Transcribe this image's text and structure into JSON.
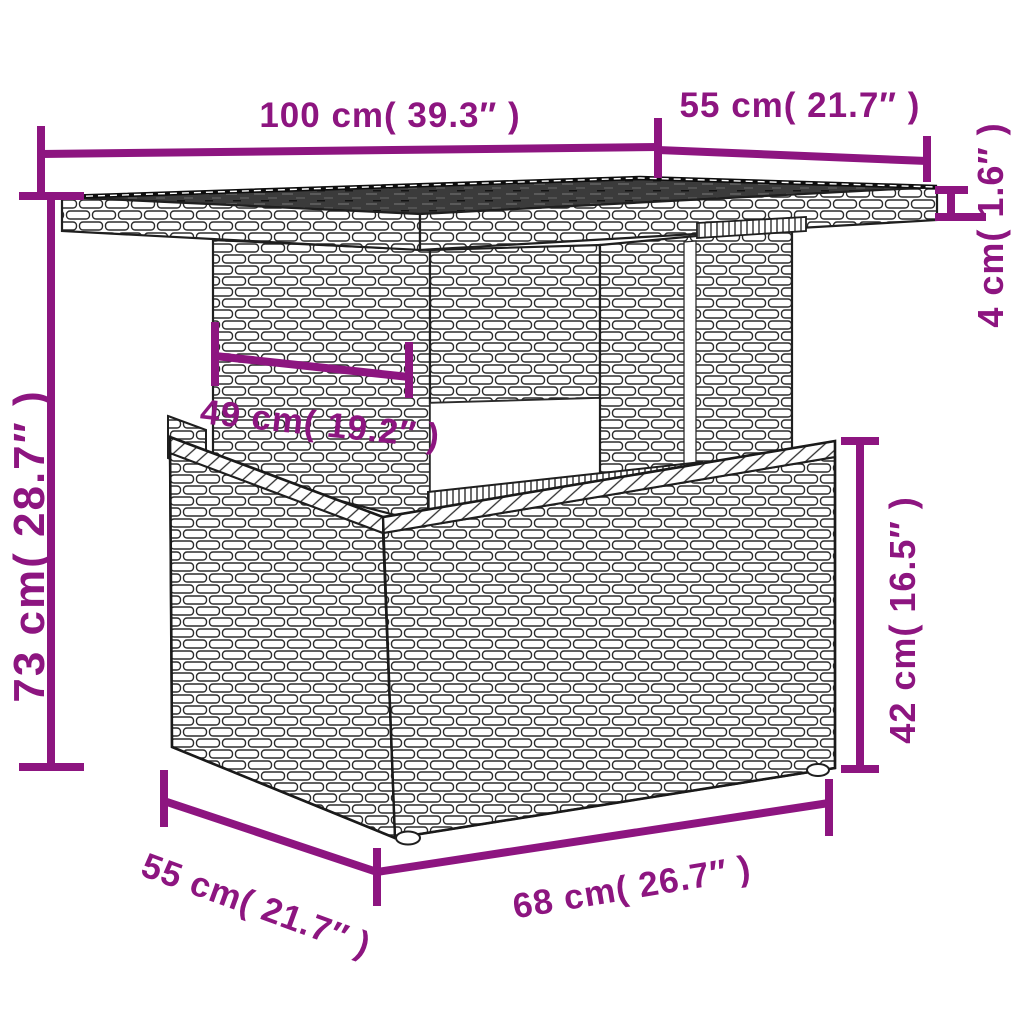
{
  "diagram": {
    "type": "product-dimension-diagram",
    "subject": "poly rattan garden table with storage base",
    "accent_color": "#8d1580",
    "line_color": "#8d1580",
    "artwork_stroke_color": "#2d2d2d"
  },
  "dimensions": {
    "top_width": "100 cm( 39.3″ )",
    "top_depth": "55 cm( 21.7″ )",
    "top_thickness": "4 cm( 1.6″ )",
    "total_height": "73 cm( 28.7″ )",
    "pedestal_width": "49 cm( 19.2″ )",
    "base_height": "42 cm( 16.5″ )",
    "base_depth": "55 cm( 21.7″ )",
    "base_width": "68 cm( 26.7″ )"
  }
}
